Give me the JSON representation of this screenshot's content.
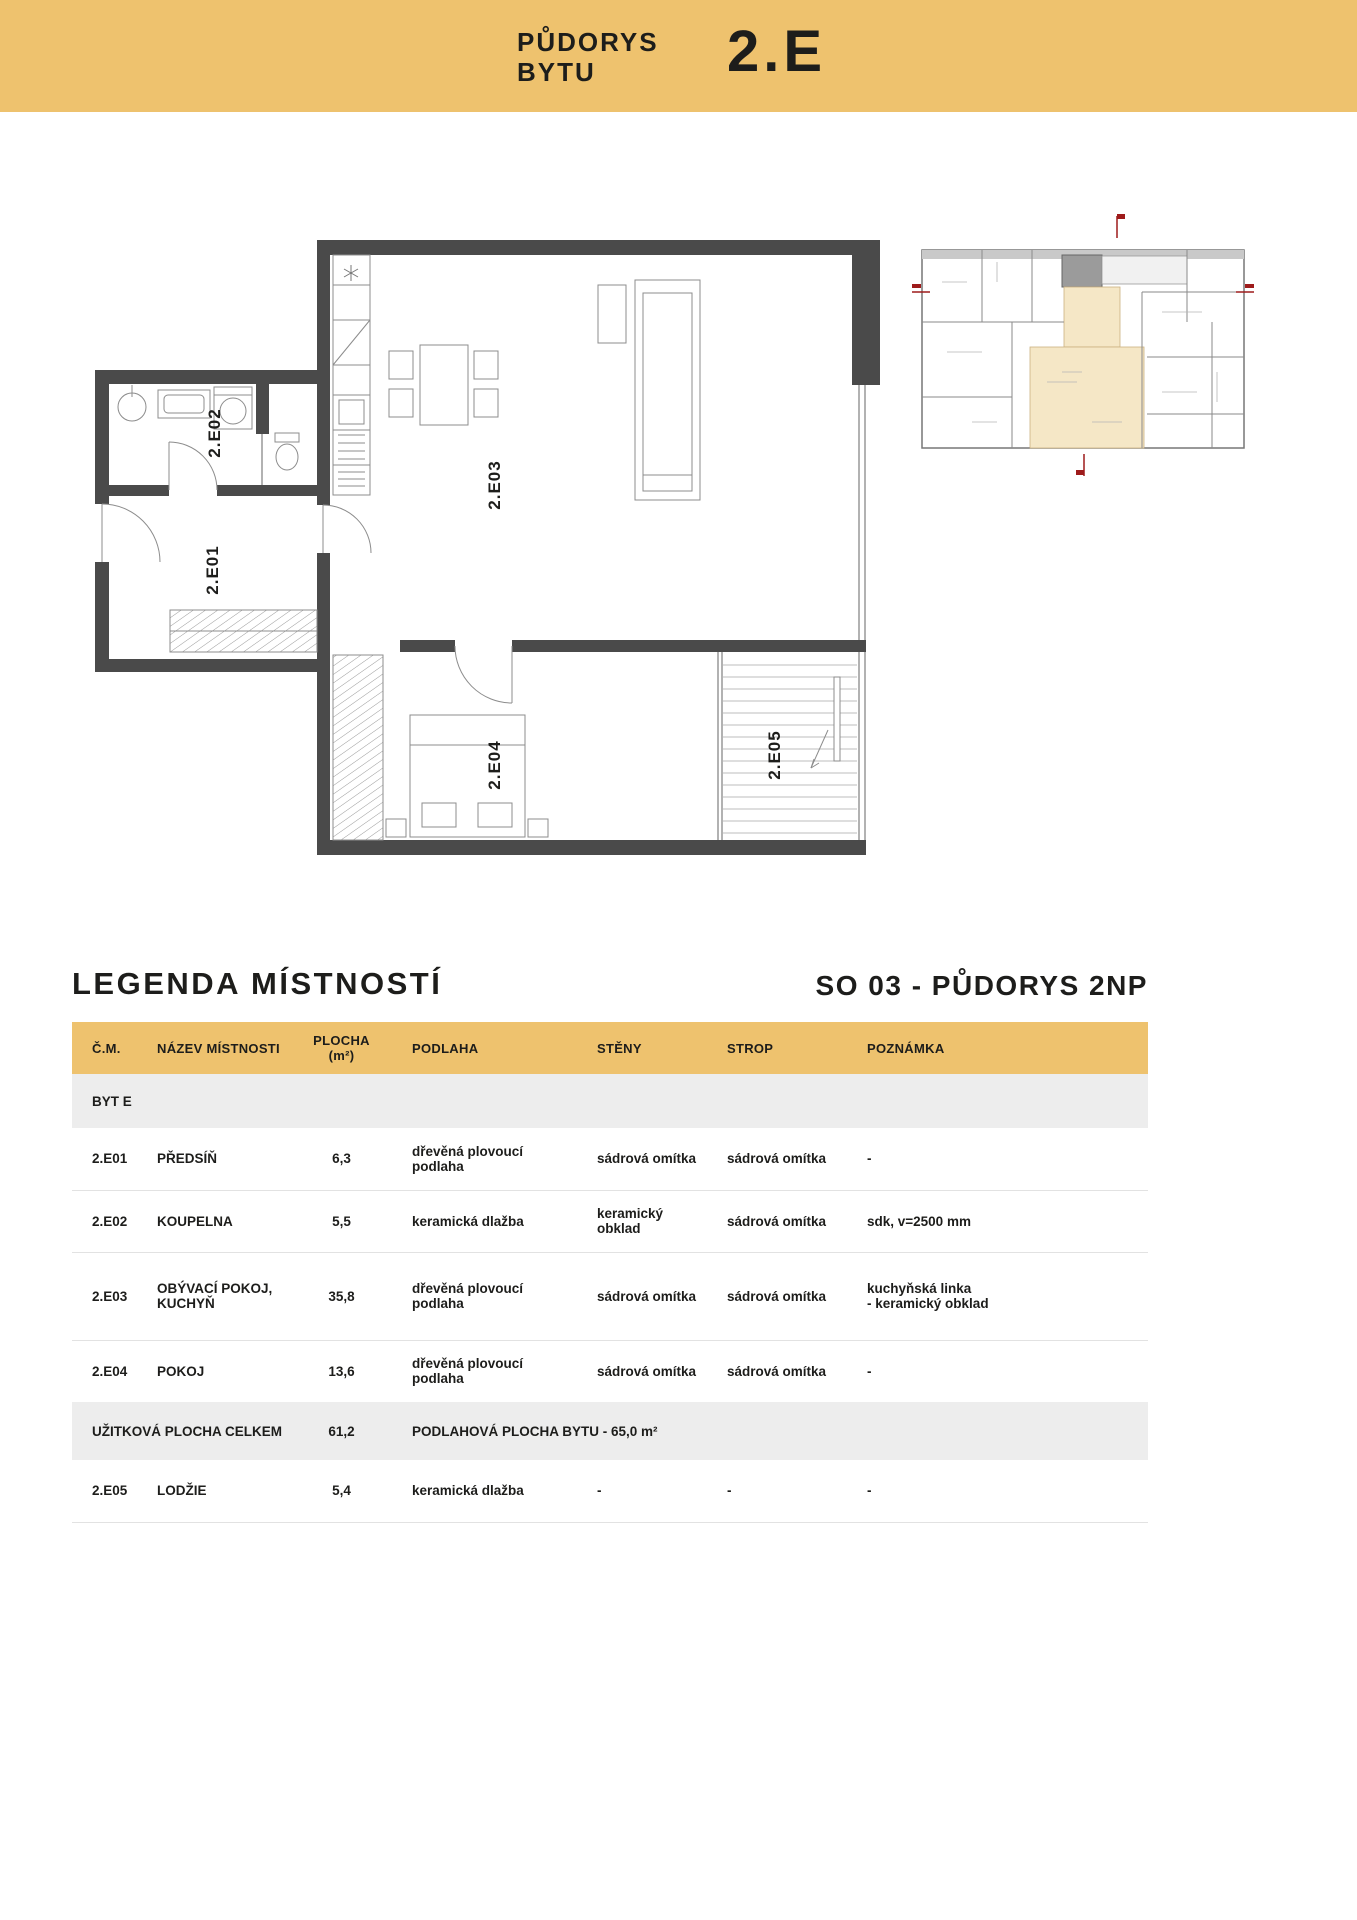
{
  "banner": {
    "title": "PŮDORYS\nBYTU",
    "unit": "2.E"
  },
  "legend": {
    "title": "LEGENDA MÍSTNOSTÍ",
    "subtitle": "SO 03 - PŮDORYS 2NP"
  },
  "plan": {
    "labels": {
      "e01": "2.E01",
      "e02": "2.E02",
      "e03": "2.E03",
      "e04": "2.E04",
      "e05": "2.E05"
    }
  },
  "table": {
    "headers": [
      "Č.M.",
      "NÁZEV MÍSTNOSTI",
      "PLOCHA\n(m²)",
      "PODLAHA",
      "STĚNY",
      "STROP",
      "POZNÁMKA"
    ],
    "section_label": "BYT E",
    "rows": [
      {
        "cm": "2.E01",
        "name": "PŘEDSÍŇ",
        "area": "6,3",
        "floor": "dřevěná plovoucí podlaha",
        "walls": "sádrová omítka",
        "ceiling": "sádrová omítka",
        "note": "-"
      },
      {
        "cm": "2.E02",
        "name": "KOUPELNA",
        "area": "5,5",
        "floor": "keramická dlažba",
        "walls": "keramický obklad",
        "ceiling": "sádrová omítka",
        "note": "sdk, v=2500 mm"
      },
      {
        "cm": "2.E03",
        "name": "OBÝVACÍ POKOJ,\nKUCHYŇ",
        "area": "35,8",
        "floor": "dřevěná plovoucí podlaha",
        "walls": "sádrová omítka",
        "ceiling": "sádrová omítka",
        "note": "kuchyňská linka\n- keramický obklad"
      },
      {
        "cm": "2.E04",
        "name": "POKOJ",
        "area": "13,6",
        "floor": "dřevěná plovoucí podlaha",
        "walls": "sádrová omítka",
        "ceiling": "sádrová omítka",
        "note": "-"
      }
    ],
    "summary": {
      "label": "UŽITKOVÁ PLOCHA CELKEM",
      "area": "61,2",
      "note": "PODLAHOVÁ PLOCHA BYTU - 65,0 m²"
    },
    "last_row": {
      "cm": "2.E05",
      "name": "LODŽIE",
      "area": "5,4",
      "floor": "keramická dlažba",
      "walls": "-",
      "ceiling": "-",
      "note": "-"
    }
  },
  "colors": {
    "accent_gold": "#eec26e",
    "row_grey": "#ededed",
    "wall_dark": "#4a4a4a",
    "highlight_beige": "#f5e7c6",
    "marker_red": "#9e1b1b"
  }
}
